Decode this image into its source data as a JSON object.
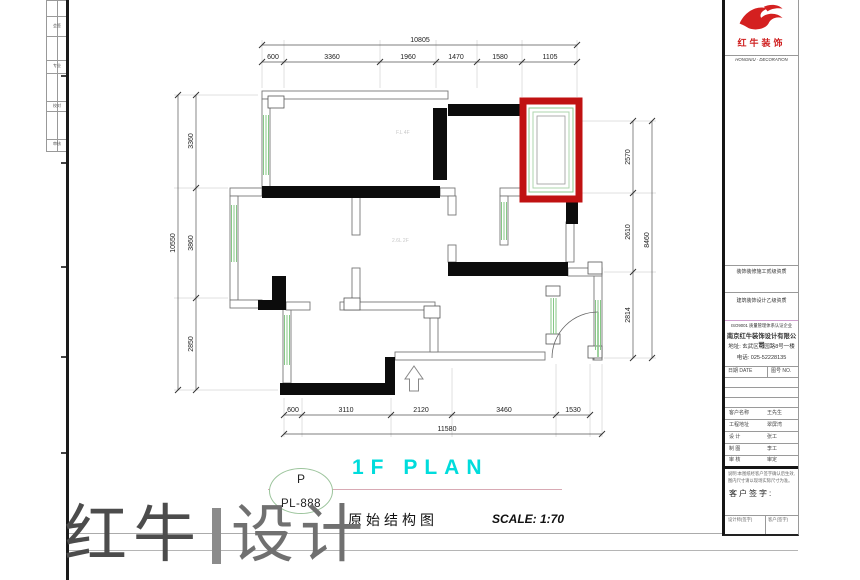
{
  "colors": {
    "accent_red": "#c01212",
    "plan_title_cyan": "#00dcdc",
    "window_green": "#86c786",
    "wall_black": "#0c0c0c"
  },
  "logo": {
    "company": "红牛装饰",
    "slogan": "HONGNIU · DECORATION"
  },
  "title_block": {
    "cert_row1": "装饰装修施工贰级资质",
    "cert_row2": "建筑装饰设计乙级资质",
    "info_header": "ISO9001 质量管理体系认证企业",
    "company": "南京红牛装饰设计有限公司",
    "address": "地址: 玄武区花园路8号一楼",
    "phone": "电话: 025-52228135",
    "meta_left": "日期 DATE",
    "meta_right": "图号 NO.",
    "rows": [
      {
        "label": "客户名称",
        "value": "王先生"
      },
      {
        "label": "工程地址",
        "value": "翠屏湾"
      },
      {
        "label": "设  计",
        "value": "张工"
      },
      {
        "label": "制  图",
        "value": "李工"
      },
      {
        "label": "审  核",
        "value": "审定"
      }
    ],
    "note_line1": "说明:本图纸经客户签字确认后生效,",
    "note_line2": "图内尺寸请以现场实际尺寸为准。",
    "sign_label": "客户签字:",
    "cell_left": "设计师(签字)",
    "cell_right": "客户(签字)"
  },
  "strip_marks": [
    "会签",
    "专业",
    "校对",
    "审核"
  ],
  "dims": {
    "top": {
      "total": "10805",
      "segments": [
        "600",
        "3360",
        "1960",
        "1470",
        "1580",
        "1105"
      ]
    },
    "bottom": {
      "total": "11580",
      "segments": [
        "600",
        "3110",
        "2120",
        "3460",
        "1530"
      ]
    },
    "left": {
      "total": "10550",
      "segments": [
        "3360",
        "3860",
        "2850"
      ]
    },
    "right": {
      "total": "8460",
      "segments": [
        "2570",
        "2610",
        "2814"
      ]
    }
  },
  "plan_annotations": {
    "a1": "F.L 4F",
    "a2": "2.6L 2F"
  },
  "title_bar": {
    "code_letter": "P",
    "code": "PL-888",
    "plan_title": "1F PLAN",
    "subtitle": "原始结构图",
    "scale": "SCALE: 1:70"
  },
  "watermark": {
    "part1": "红牛",
    "part2": "设计"
  }
}
